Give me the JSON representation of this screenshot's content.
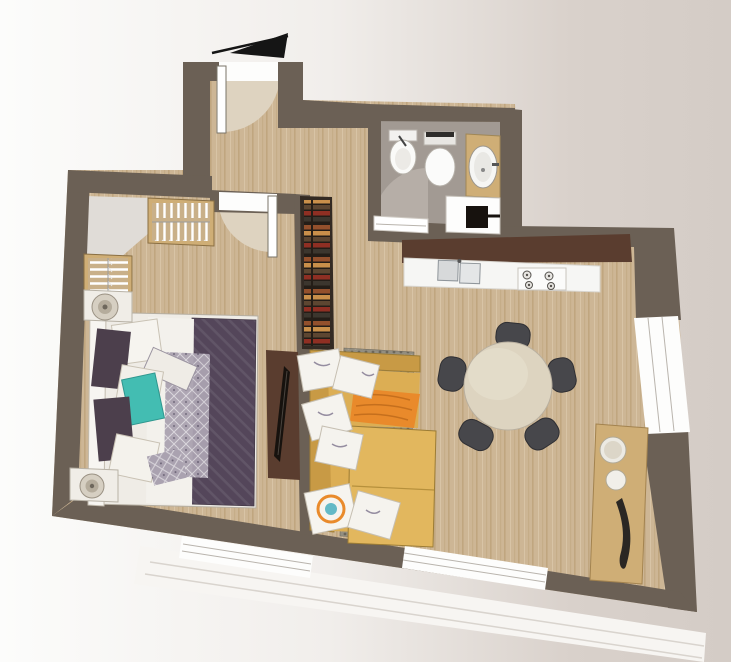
{
  "plan": {
    "type": "apartment-floor-plan-render",
    "labels": {
      "entry_arrow": "entrance direction arrow",
      "entry_door": "entrance door with swing",
      "interior_door": "bedroom door with swing",
      "bathroom_door": "bathroom door with swing",
      "bedroom": "bedroom",
      "bathroom": "bathroom",
      "kitchen": "kitchen counter",
      "living": "living room",
      "bed": "double bed with pillows",
      "nightstand_n": "nightstand with lamp",
      "nightstand_s": "nightstand with lamp",
      "wardrobe_n": "wardrobe with hangers",
      "wardrobe_w": "wardrobe with hangers",
      "closet": "dressing corner",
      "tv": "wall TV panel",
      "bookshelf": "bookshelf",
      "sofa": "corner sofa with cushions",
      "throw": "orange throw blanket",
      "rug": "area rug",
      "dining": "round dining table with five chairs",
      "console": "sideboard with decor",
      "bidet": "bidet",
      "toilet": "toilet",
      "basin": "washbasin on counter",
      "washer": "washing machine",
      "sink": "double kitchen sink",
      "hob": "cooktop",
      "window_bed": "bedroom window",
      "window_living": "living room window",
      "window_east": "east window",
      "terrace": "terrace edge"
    }
  },
  "colors": {
    "bg_left": "#fcfcfb",
    "bg_mid": "#f1eeeb",
    "bg_right2": "#d9d1cb",
    "bg_right": "#d4ccc6",
    "wall": "#6b6055",
    "kitchen_wall": "#5a3d2f",
    "tv_black": "#17120e",
    "floor_wood": "#cdb695",
    "floor_wood_grain": "#c0a67f",
    "floor_tile": "#a29a93",
    "tile_arc": "#b6aea7",
    "closet_floor": "#e0dcd7",
    "door_arc": "#ded3c0",
    "window_white": "#fdfdfc",
    "window_line": "#b9b4ad",
    "counter": "#f6f6f4",
    "console_wood": "#cfae76",
    "bed_frame": "#efece6",
    "bed_quilt": "#54465a",
    "bed_gray": "#aaa2b0",
    "pillow_dark": "#4c3f4c",
    "pillow_teal": "#43bdb2",
    "sofa": "#dcae54",
    "sofa_back": "#c89a45",
    "sofa_seat": "#e2b75e",
    "throw": "#e98a2b",
    "rug_base": "#938e80",
    "rug_dark": "#6b665a",
    "rug_light": "#aaa496",
    "table_top": "#ddd4c0",
    "chair": "#47474b",
    "book1": "#93502c",
    "book2": "#c98f4a",
    "book3": "#5d4631",
    "book4": "#8f2f23",
    "book5": "#3c362e",
    "arrow": "#151515",
    "terrace": "#f7f5f2",
    "terrace_line": "#d9d4ce"
  }
}
